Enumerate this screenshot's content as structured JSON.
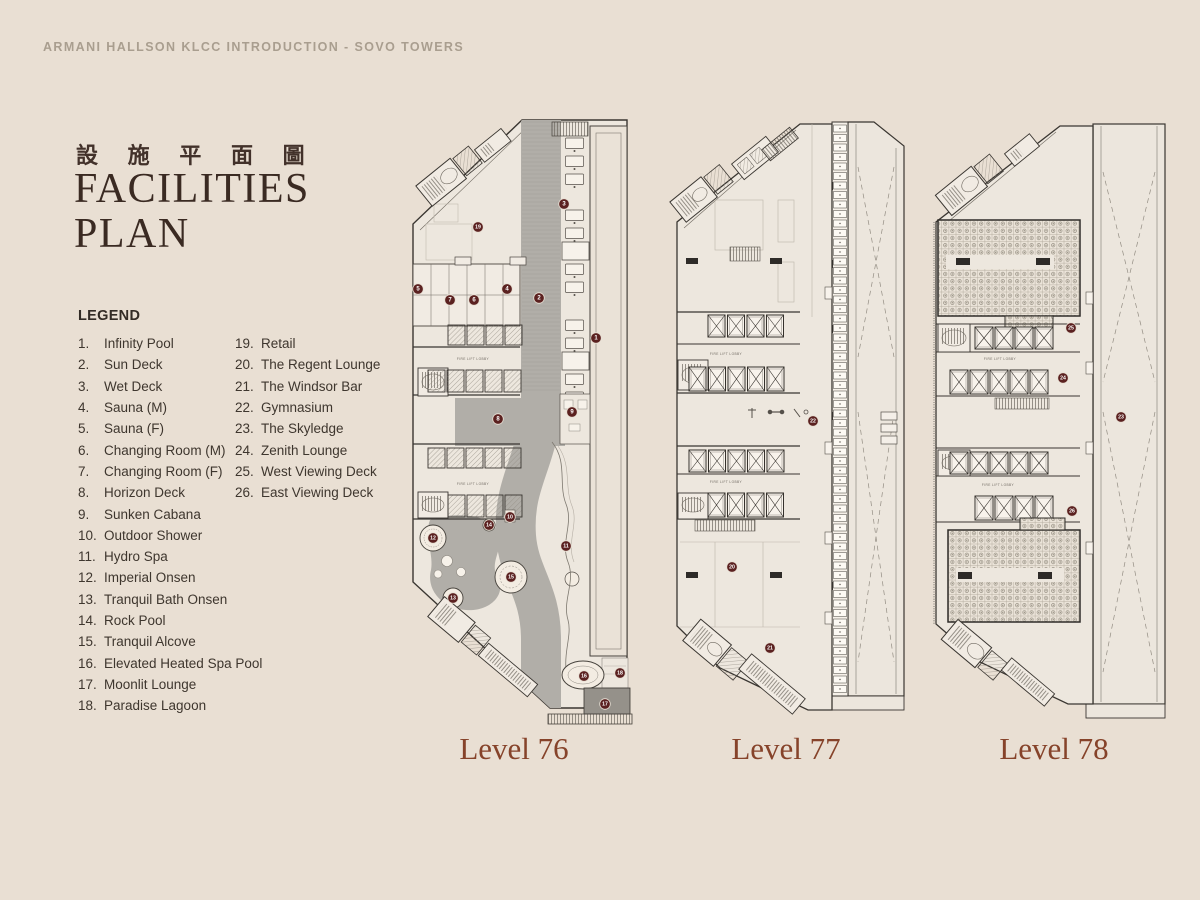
{
  "header": {
    "text": "ARMANI HALLSON KLCC INTRODUCTION - SOVO TOWERS"
  },
  "title": {
    "chinese": "設 施 平 面 圖",
    "line1": "FACILITIES",
    "line2": "PLAN"
  },
  "legend": {
    "heading": "LEGEND",
    "column_break": 18,
    "items": [
      {
        "num": "1.",
        "label": "Infinity Pool"
      },
      {
        "num": "2.",
        "label": "Sun Deck"
      },
      {
        "num": "3.",
        "label": "Wet Deck"
      },
      {
        "num": "4.",
        "label": "Sauna (M)"
      },
      {
        "num": "5.",
        "label": "Sauna (F)"
      },
      {
        "num": "6.",
        "label": "Changing Room (M)"
      },
      {
        "num": "7.",
        "label": "Changing Room (F)"
      },
      {
        "num": "8.",
        "label": "Horizon Deck"
      },
      {
        "num": "9.",
        "label": "Sunken Cabana"
      },
      {
        "num": "10.",
        "label": "Outdoor Shower"
      },
      {
        "num": "11.",
        "label": "Hydro Spa"
      },
      {
        "num": "12.",
        "label": "Imperial Onsen"
      },
      {
        "num": "13.",
        "label": "Tranquil Bath Onsen"
      },
      {
        "num": "14.",
        "label": "Rock Pool"
      },
      {
        "num": "15.",
        "label": "Tranquil Alcove"
      },
      {
        "num": "16.",
        "label": "Elevated Heated Spa Pool"
      },
      {
        "num": "17.",
        "label": "Moonlit Lounge"
      },
      {
        "num": "18.",
        "label": "Paradise Lagoon"
      },
      {
        "num": "19.",
        "label": "Retail"
      },
      {
        "num": "20.",
        "label": "The Regent Lounge"
      },
      {
        "num": "21.",
        "label": "The Windsor Bar"
      },
      {
        "num": "22.",
        "label": "Gymnasium"
      },
      {
        "num": "23.",
        "label": "The Skyledge"
      },
      {
        "num": "24.",
        "label": "Zenith Lounge"
      },
      {
        "num": "25.",
        "label": "West Viewing Deck"
      },
      {
        "num": "26.",
        "label": "East Viewing Deck"
      }
    ]
  },
  "plan_text": {
    "fire_lift_lobby": "FIRE LIFT LOBBY"
  },
  "levels": [
    {
      "name": "Level 76",
      "markers": [
        {
          "n": 19,
          "x": 78,
          "y": 115
        },
        {
          "n": 3,
          "x": 164,
          "y": 92
        },
        {
          "n": 2,
          "x": 139,
          "y": 186
        },
        {
          "n": 1,
          "x": 196,
          "y": 226
        },
        {
          "n": 5,
          "x": 18,
          "y": 177
        },
        {
          "n": 7,
          "x": 50,
          "y": 188
        },
        {
          "n": 6,
          "x": 74,
          "y": 188
        },
        {
          "n": 4,
          "x": 107,
          "y": 177
        },
        {
          "n": 8,
          "x": 98,
          "y": 307
        },
        {
          "n": 9,
          "x": 172,
          "y": 300
        },
        {
          "n": 14,
          "x": 89,
          "y": 413
        },
        {
          "n": 10,
          "x": 110,
          "y": 405
        },
        {
          "n": 12,
          "x": 33,
          "y": 426
        },
        {
          "n": 11,
          "x": 166,
          "y": 434
        },
        {
          "n": 15,
          "x": 111,
          "y": 465
        },
        {
          "n": 13,
          "x": 53,
          "y": 486
        },
        {
          "n": 16,
          "x": 184,
          "y": 564
        },
        {
          "n": 18,
          "x": 220,
          "y": 561
        },
        {
          "n": 17,
          "x": 205,
          "y": 592
        }
      ]
    },
    {
      "name": "Level 77",
      "markers": [
        {
          "n": 22,
          "x": 153,
          "y": 309
        },
        {
          "n": 20,
          "x": 72,
          "y": 455
        },
        {
          "n": 21,
          "x": 110,
          "y": 536
        }
      ]
    },
    {
      "name": "Level 78",
      "markers": [
        {
          "n": 25,
          "x": 151,
          "y": 216
        },
        {
          "n": 24,
          "x": 143,
          "y": 266
        },
        {
          "n": 23,
          "x": 201,
          "y": 305
        },
        {
          "n": 26,
          "x": 152,
          "y": 399
        }
      ]
    }
  ],
  "colors": {
    "background": "#e9dfd3",
    "accent_rust": "#86432a",
    "marker": "#5b2120",
    "title": "#3a2a22",
    "header_text": "#a99e8f",
    "plan_line": "#3a3631",
    "deck_gray": "#b1aea8",
    "dark_gray": "#95918a"
  }
}
